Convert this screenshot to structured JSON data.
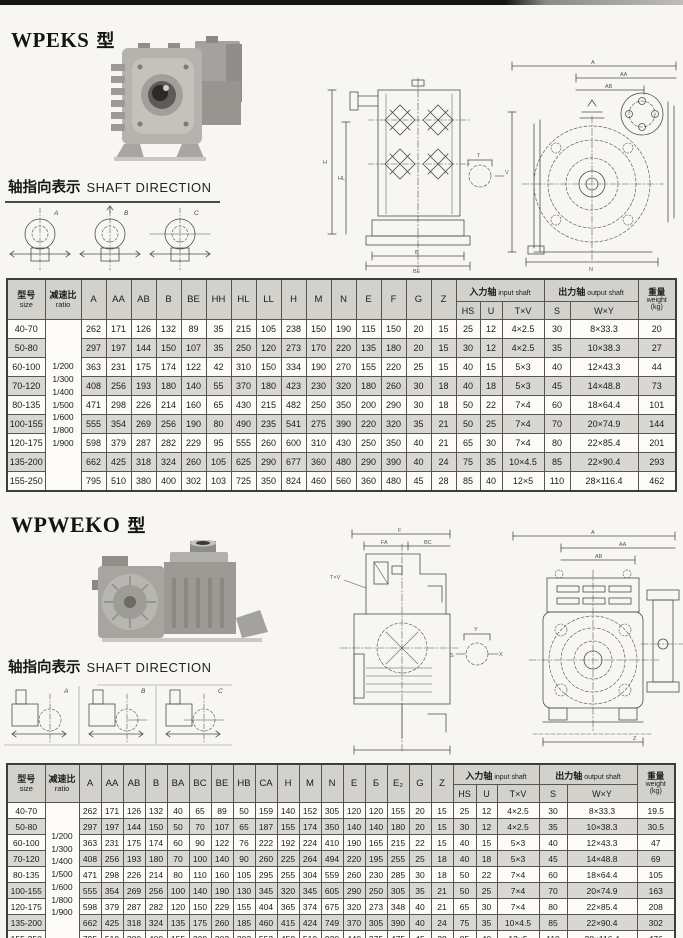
{
  "labels": {
    "type_suffix": "型",
    "shaft_direction_zh": "轴指向表示",
    "shaft_direction_en": "SHAFT DIRECTION"
  },
  "drawings": {
    "letters": [
      "A",
      "B",
      "C"
    ],
    "dim_labels": {
      "A": "A",
      "AA": "AA",
      "AB": "AB",
      "H": "H",
      "HL": "HL",
      "B": "B",
      "BE": "BE",
      "N": "N",
      "F": "F",
      "FA": "FA",
      "BC": "BC",
      "T": "T",
      "V": "V",
      "Y": "Y",
      "X": "X",
      "S": "S",
      "TXV": "T×V",
      "Z": "Z",
      "E": "E"
    }
  },
  "sections": [
    {
      "title": "WPEKS",
      "table": {
        "header": {
          "size_zh": "型号",
          "size_en": "size",
          "ratio_zh": "减速比",
          "ratio_en": "ratio",
          "dims": [
            "A",
            "AA",
            "AB",
            "B",
            "BE",
            "HH",
            "HL",
            "LL",
            "H",
            "M",
            "N",
            "E",
            "F",
            "G",
            "Z"
          ],
          "input_zh": "入力轴",
          "input_en": "input shaft",
          "input_cols": [
            "HS",
            "U",
            "T×V"
          ],
          "output_zh": "出力轴",
          "output_en": "output shaft",
          "output_cols": [
            "S",
            "W×Y"
          ],
          "weight_zh": "重量",
          "weight_en": "weight",
          "weight_unit": "(kg)"
        },
        "ratios": [
          "1/200",
          "1/300",
          "1/400",
          "1/500",
          "1/600",
          "1/800",
          "1/900"
        ],
        "rows": [
          {
            "size": "40-70",
            "dims": [
              262,
              171,
              126,
              132,
              89,
              35,
              215,
              105,
              238,
              150,
              190,
              115,
              150,
              20,
              15
            ],
            "input": [
              "25",
              "12",
              "4×2.5"
            ],
            "output": [
              "30",
              "8×33.3"
            ],
            "weight": "20"
          },
          {
            "size": "50-80",
            "dims": [
              297,
              197,
              144,
              150,
              107,
              35,
              250,
              120,
              273,
              170,
              220,
              135,
              180,
              20,
              15
            ],
            "input": [
              "30",
              "12",
              "4×2.5"
            ],
            "output": [
              "35",
              "10×38.3"
            ],
            "weight": "27"
          },
          {
            "size": "60-100",
            "dims": [
              363,
              231,
              175,
              174,
              122,
              42,
              310,
              150,
              334,
              190,
              270,
              155,
              220,
              25,
              15
            ],
            "input": [
              "40",
              "15",
              "5×3"
            ],
            "output": [
              "40",
              "12×43.3"
            ],
            "weight": "44"
          },
          {
            "size": "70-120",
            "dims": [
              408,
              256,
              193,
              180,
              140,
              55,
              370,
              180,
              423,
              230,
              320,
              180,
              260,
              30,
              18
            ],
            "input": [
              "40",
              "18",
              "5×3"
            ],
            "output": [
              "45",
              "14×48.8"
            ],
            "weight": "73"
          },
          {
            "size": "80-135",
            "dims": [
              471,
              298,
              226,
              214,
              160,
              65,
              430,
              215,
              482,
              250,
              350,
              200,
              290,
              30,
              18
            ],
            "input": [
              "50",
              "22",
              "7×4"
            ],
            "output": [
              "60",
              "18×64.4"
            ],
            "weight": "101"
          },
          {
            "size": "100-155",
            "dims": [
              555,
              354,
              269,
              256,
              190,
              80,
              490,
              235,
              541,
              275,
              390,
              220,
              320,
              35,
              21
            ],
            "input": [
              "50",
              "25",
              "7×4"
            ],
            "output": [
              "70",
              "20×74.9"
            ],
            "weight": "144"
          },
          {
            "size": "120-175",
            "dims": [
              598,
              379,
              287,
              282,
              229,
              95,
              555,
              260,
              600,
              310,
              430,
              250,
              350,
              40,
              21
            ],
            "input": [
              "65",
              "30",
              "7×4"
            ],
            "output": [
              "80",
              "22×85.4"
            ],
            "weight": "201"
          },
          {
            "size": "135-200",
            "dims": [
              662,
              425,
              318,
              324,
              260,
              105,
              625,
              290,
              677,
              360,
              480,
              290,
              390,
              40,
              24
            ],
            "input": [
              "75",
              "35",
              "10×4.5"
            ],
            "output": [
              "85",
              "22×90.4"
            ],
            "weight": "293"
          },
          {
            "size": "155-250",
            "dims": [
              795,
              510,
              380,
              400,
              302,
              103,
              725,
              350,
              824,
              460,
              560,
              360,
              480,
              45,
              28
            ],
            "input": [
              "85",
              "40",
              "12×5"
            ],
            "output": [
              "110",
              "28×116.4"
            ],
            "weight": "462"
          }
        ]
      }
    },
    {
      "title": "WPWEKO",
      "table": {
        "header": {
          "size_zh": "型号",
          "size_en": "size",
          "ratio_zh": "减速比",
          "ratio_en": "ratio",
          "dims": [
            "A",
            "AA",
            "AB",
            "B",
            "BA",
            "BC",
            "BE",
            "HB",
            "CA",
            "H",
            "M",
            "N",
            "E",
            "Б",
            "E₂",
            "G",
            "Z"
          ],
          "input_zh": "入力轴",
          "input_en": "input shaft",
          "input_cols": [
            "HS",
            "U",
            "T×V"
          ],
          "output_zh": "出力轴",
          "output_en": "output shaft",
          "output_cols": [
            "S",
            "W×Y"
          ],
          "weight_zh": "重量",
          "weight_en": "weight",
          "weight_unit": "(kg)"
        },
        "ratios": [
          "1/200",
          "1/300",
          "1/400",
          "1/500",
          "1/600",
          "1/800",
          "1/900"
        ],
        "rows": [
          {
            "size": "40-70",
            "dims": [
              262,
              171,
              126,
              132,
              40,
              65,
              89,
              50,
              159,
              140,
              152,
              305,
              120,
              120,
              155,
              20,
              15
            ],
            "input": [
              "25",
              "12",
              "4×2.5"
            ],
            "output": [
              "30",
              "8×33.3"
            ],
            "weight": "19.5"
          },
          {
            "size": "50-80",
            "dims": [
              297,
              197,
              144,
              150,
              50,
              70,
              107,
              65,
              187,
              155,
              174,
              350,
              140,
              140,
              180,
              20,
              15
            ],
            "input": [
              "30",
              "12",
              "4×2.5"
            ],
            "output": [
              "35",
              "10×38.3"
            ],
            "weight": "30.5"
          },
          {
            "size": "60-100",
            "dims": [
              363,
              231,
              175,
              174,
              60,
              90,
              122,
              76,
              222,
              192,
              224,
              410,
              190,
              165,
              215,
              22,
              15
            ],
            "input": [
              "40",
              "15",
              "5×3"
            ],
            "output": [
              "40",
              "12×43.3"
            ],
            "weight": "47"
          },
          {
            "size": "70-120",
            "dims": [
              408,
              256,
              193,
              180,
              70,
              100,
              140,
              90,
              260,
              225,
              264,
              494,
              220,
              195,
              255,
              25,
              18
            ],
            "input": [
              "40",
              "18",
              "5×3"
            ],
            "output": [
              "45",
              "14×48.8"
            ],
            "weight": "69"
          },
          {
            "size": "80-135",
            "dims": [
              471,
              298,
              226,
              214,
              80,
              110,
              160,
              105,
              295,
              255,
              304,
              559,
              260,
              230,
              285,
              30,
              18
            ],
            "input": [
              "50",
              "22",
              "7×4"
            ],
            "output": [
              "60",
              "18×64.4"
            ],
            "weight": "105"
          },
          {
            "size": "100-155",
            "dims": [
              555,
              354,
              269,
              256,
              100,
              140,
              190,
              130,
              345,
              320,
              345,
              605,
              290,
              250,
              305,
              35,
              21
            ],
            "input": [
              "50",
              "25",
              "7×4"
            ],
            "output": [
              "70",
              "20×74.9"
            ],
            "weight": "163"
          },
          {
            "size": "120-175",
            "dims": [
              598,
              379,
              287,
              282,
              120,
              150,
              229,
              155,
              404,
              365,
              374,
              675,
              320,
              273,
              348,
              40,
              21
            ],
            "input": [
              "65",
              "30",
              "7×4"
            ],
            "output": [
              "80",
              "22×85.4"
            ],
            "weight": "208"
          },
          {
            "size": "135-200",
            "dims": [
              662,
              425,
              318,
              324,
              135,
              175,
              260,
              185,
              460,
              415,
              424,
              749,
              370,
              305,
              390,
              40,
              24
            ],
            "input": [
              "75",
              "35",
              "10×4.5"
            ],
            "output": [
              "85",
              "22×90.4"
            ],
            "weight": "302"
          },
          {
            "size": "155-250",
            "dims": [
              795,
              510,
              380,
              400,
              155,
              200,
              302,
              203,
              552,
              458,
              510,
              920,
              440,
              375,
              475,
              45,
              28
            ],
            "input": [
              "85",
              "40",
              "12×5"
            ],
            "output": [
              "110",
              "28×116.4"
            ],
            "weight": "476"
          }
        ]
      }
    }
  ]
}
